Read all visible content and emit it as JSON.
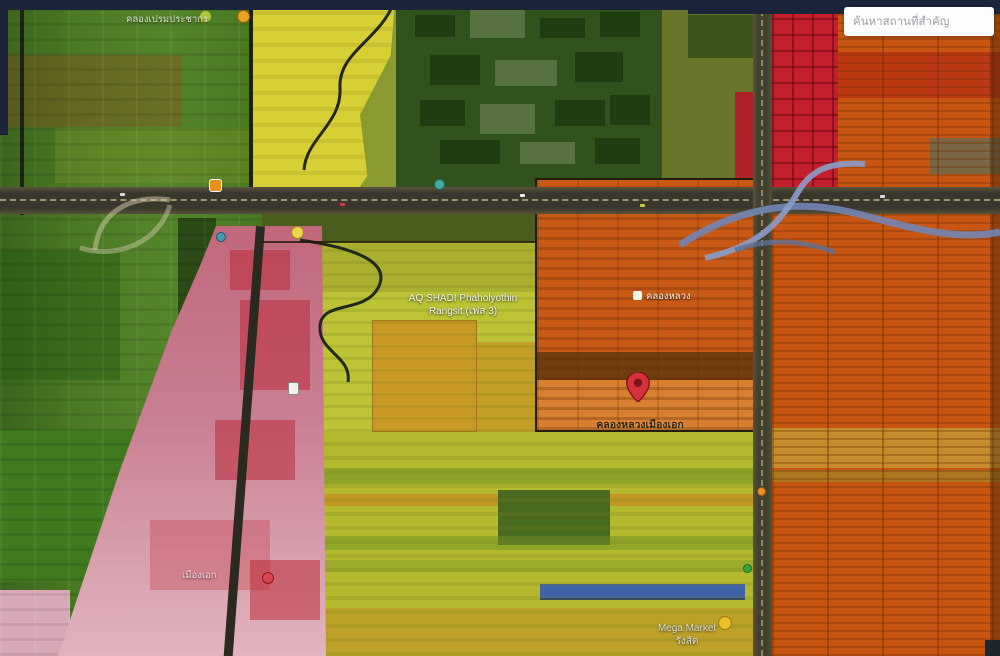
{
  "search": {
    "placeholder": "ค้นหาสถานที่สำคัญ"
  },
  "map": {
    "labels": {
      "top_left_place": "คลองเปรมประชากร",
      "project_line1": "AQ SHADI Phaholyothin",
      "project_line2": "Rangsit (เฟส 3)",
      "district": "คลองหลวง",
      "pin_place": "คลองหลวงเมืองเอก",
      "muang_ake": "เมืองเอก",
      "megamarket_line1": "Mega Market",
      "megamarket_line2": "รังสิต"
    }
  },
  "palette": {
    "zone_green": "#4c7a24",
    "zone_campus_green": "#31521c",
    "zone_yellow": "#d6cf35",
    "zone_yellow_green": "#bcc334",
    "zone_olive": "#b4b92e",
    "zone_orange_center": "#c85a16",
    "zone_orange_right": "#c85612",
    "zone_red": "#c41f2c",
    "zone_pink": "#c97f92",
    "road_dark": "#3a382c",
    "flyover_blue": "#7285b5",
    "mega_roof_blue": "#3e63a8",
    "pin_red": "#d6303a",
    "top_bar_navy": "#1b2438"
  }
}
